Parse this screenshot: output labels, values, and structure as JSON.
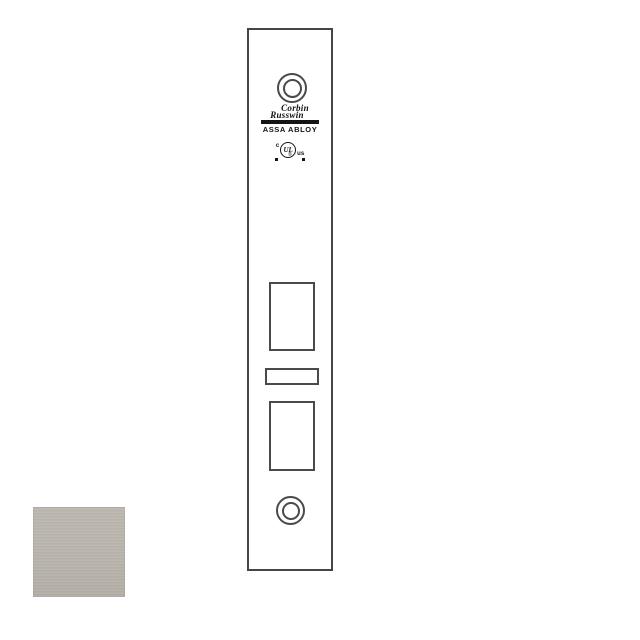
{
  "page": {
    "background_color": "#ffffff"
  },
  "drawing": {
    "line_color": "#4a4a4a",
    "brand": {
      "name_line1": "Corbin",
      "name_line2": "Russwin",
      "group": "ASSA ABLOY"
    },
    "certification": {
      "prefix": "c",
      "mark": "UL",
      "suffix": "us",
      "registered": "®"
    }
  },
  "finish_swatch": {
    "color": "#b9b4ac"
  }
}
